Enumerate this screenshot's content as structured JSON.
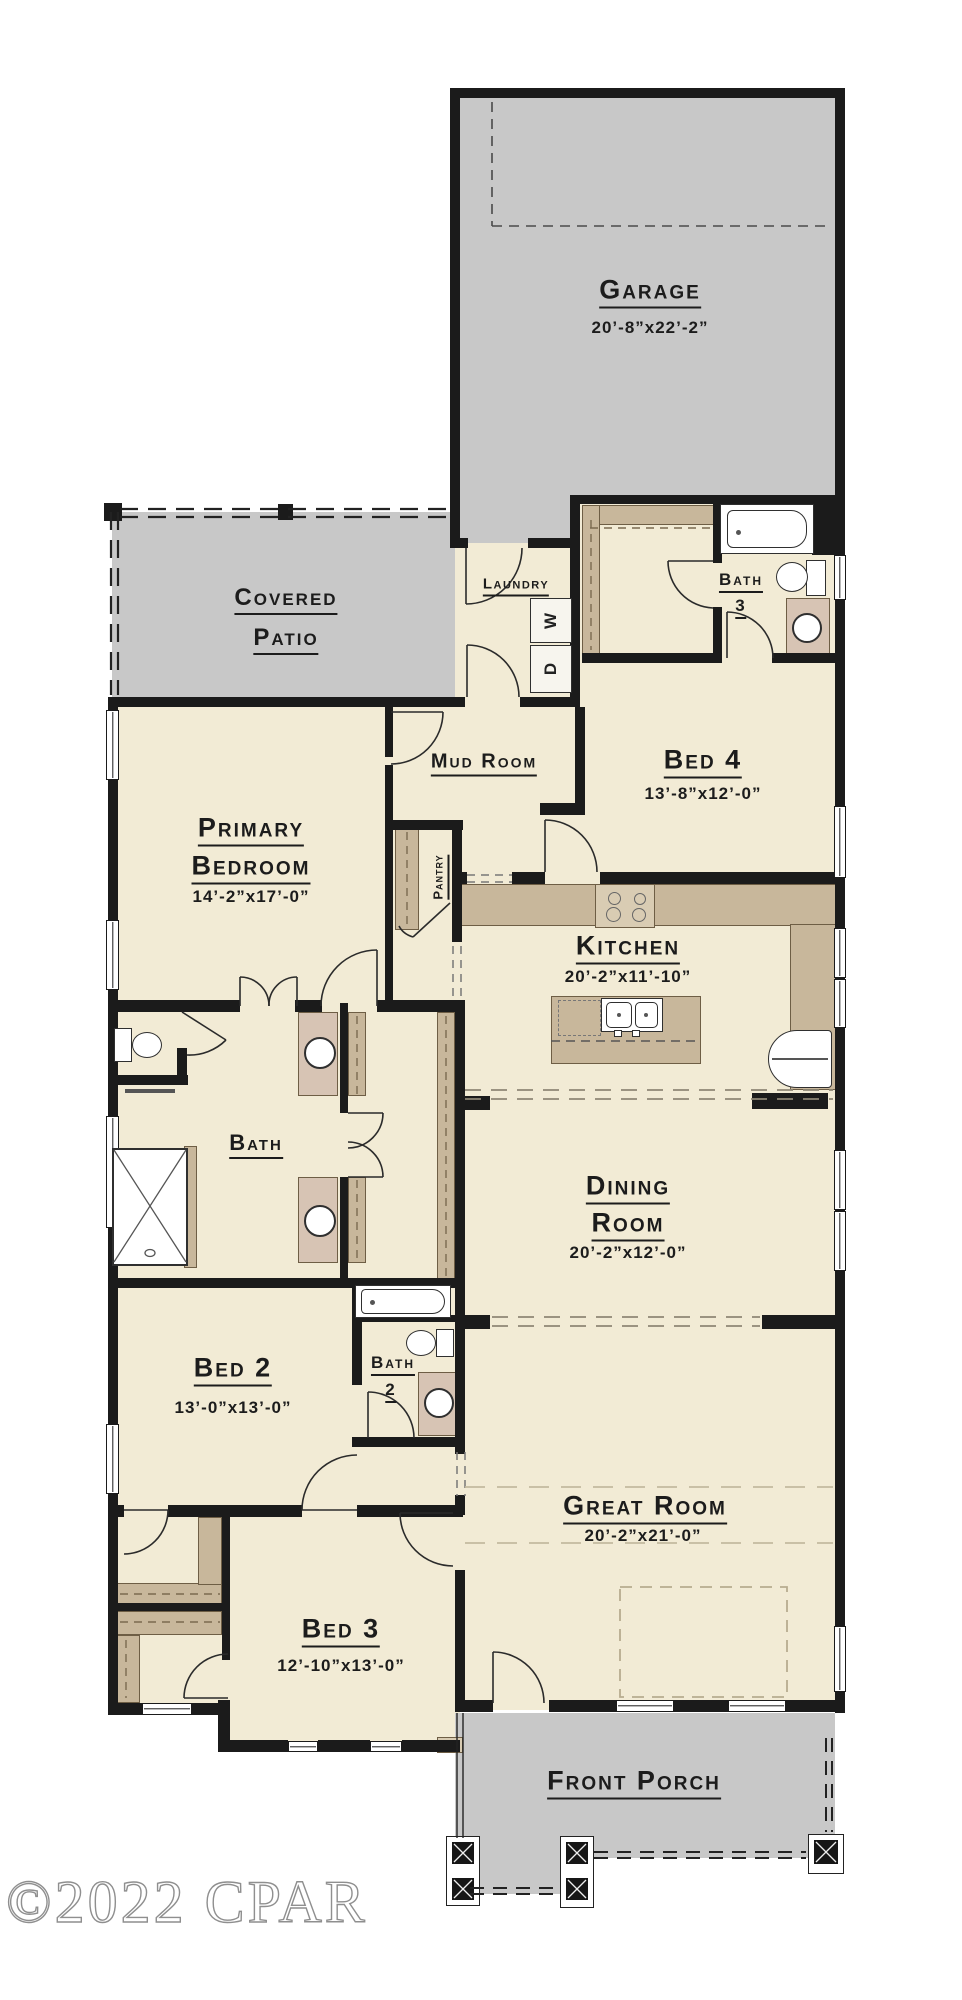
{
  "palette": {
    "floor_cream": "#f2ebd5",
    "concrete_gray": "#c8c8c8",
    "wall_black": "#1b1b1b",
    "cabinet_tan": "#c8b79b",
    "vanity_tan": "#d7c4b4"
  },
  "watermark": "©2022 CPAR",
  "rooms": {
    "garage": {
      "name": "Garage",
      "dims": "20’-8”x22’-2”"
    },
    "covered_patio": {
      "line1": "Covered",
      "line2": "Patio"
    },
    "laundry": {
      "name": "Laundry"
    },
    "bath3": {
      "name": "Bath",
      "number": "3"
    },
    "mud_room": {
      "name": "Mud Room"
    },
    "bed4": {
      "name": "Bed 4",
      "dims": "13’-8”x12’-0”"
    },
    "primary_bedroom": {
      "line1": "Primary",
      "line2": "Bedroom",
      "dims": "14’-2”x17’-0”"
    },
    "pantry": {
      "name": "Pantry"
    },
    "kitchen": {
      "name": "Kitchen",
      "dims": "20’-2”x11’-10”"
    },
    "bath_primary": {
      "name": "Bath"
    },
    "dining_room": {
      "line1": "Dining",
      "line2": "Room",
      "dims": "20’-2”x12’-0”"
    },
    "bed2": {
      "name": "Bed 2",
      "dims": "13’-0”x13’-0”"
    },
    "bath2": {
      "name": "Bath",
      "number": "2"
    },
    "great_room": {
      "name": "Great Room",
      "dims": "20’-2”x21’-0”"
    },
    "bed3": {
      "name": "Bed 3",
      "dims": "12’-10”x13’-0”"
    },
    "front_porch": {
      "name": "Front Porch"
    }
  },
  "appliances": {
    "washer": "W",
    "dryer": "D"
  }
}
